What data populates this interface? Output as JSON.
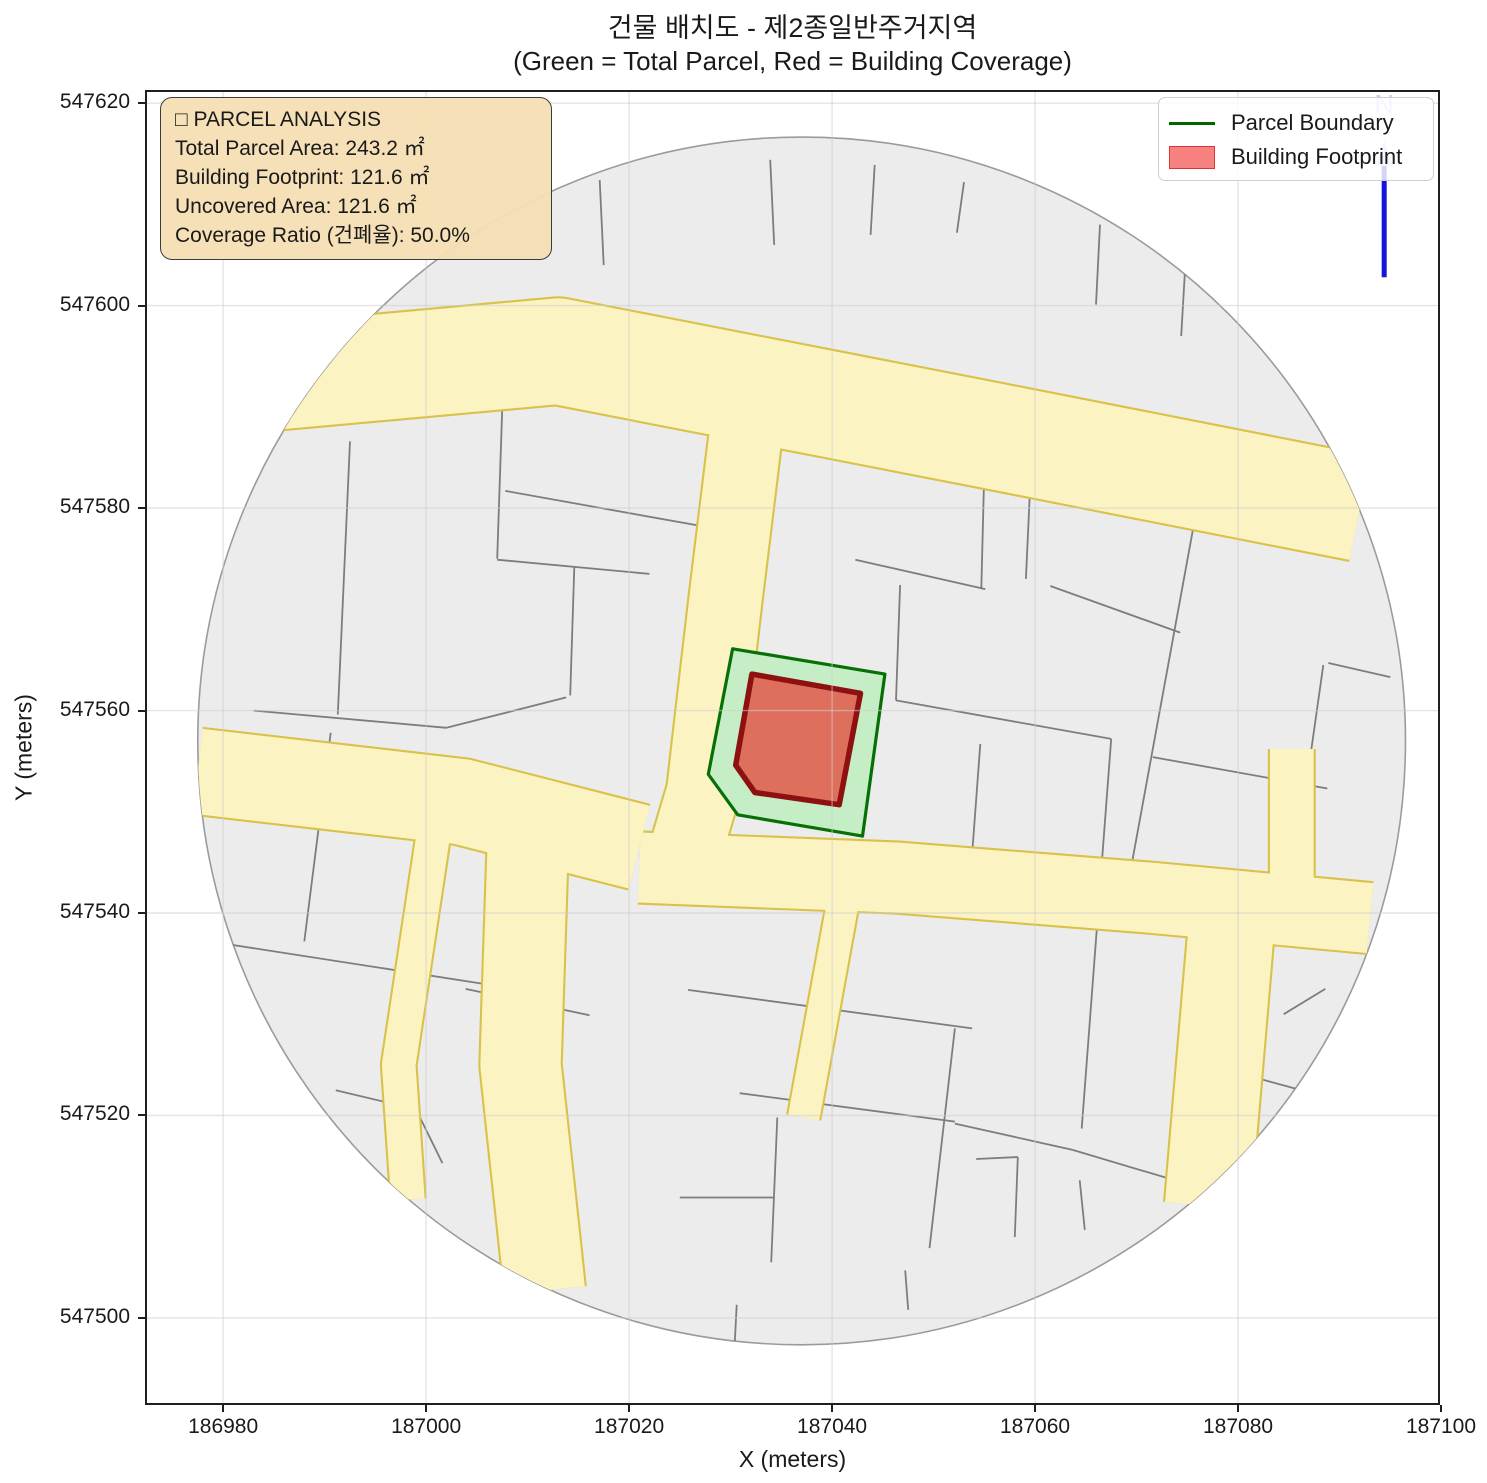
{
  "title": {
    "line1": "건물 배치도 - 제2종일반주거지역",
    "line2": "(Green = Total Parcel, Red = Building Coverage)"
  },
  "info_box": {
    "title": "□ PARCEL ANALYSIS",
    "lines": [
      "Total Parcel Area: 243.2 ㎡",
      "Building Footprint: 121.6 ㎡",
      "Uncovered Area: 121.6 ㎡",
      "Coverage Ratio (건폐율): 50.0%"
    ]
  },
  "legend": {
    "items": [
      {
        "label": "Parcel Boundary",
        "type": "line",
        "color": "#006400"
      },
      {
        "label": "Building Footprint",
        "type": "patch",
        "fill": "#f78080",
        "edge": "#dd3333"
      }
    ]
  },
  "colors": {
    "background": "#ffffff",
    "parcel_fill": "#ececec",
    "parcel_edge": "#7d7d7d",
    "road_fill": "#fcf3c3",
    "road_edge": "#d9c24a",
    "region_edge": "#9b9b9b",
    "grid": "rgba(205,205,205,0.55)",
    "target_parcel_fill": "#c6eec6",
    "target_parcel_edge": "#067006",
    "building_fill": "#df6f5d",
    "building_edge": "#8e1111",
    "north_arrow": "#1414dd",
    "north_faint": "rgba(125,135,235,0.45)",
    "infobox_bg": "rgba(245,222,179,0.95)",
    "infobox_border": "#3b3b3b",
    "spine": "#1f1f1f"
  },
  "chart_data": {
    "type": "map",
    "title": "건물 배치도 - 제2종일반주거지역",
    "subtitle": "(Green = Total Parcel, Red = Building Coverage)",
    "xlabel": "X (meters)",
    "ylabel": "Y (meters)",
    "xlim": [
      186972.3,
      187099.9
    ],
    "ylim": [
      547491.4,
      547621.3
    ],
    "x_ticks": [
      186980,
      187000,
      187020,
      187040,
      187060,
      187080,
      187100
    ],
    "y_ticks": [
      547500,
      547520,
      547540,
      547560,
      547580,
      547600,
      547620
    ],
    "grid": true,
    "legend_position": "upper right",
    "analysis": {
      "zoning": "제2종일반주거지역",
      "total_parcel_area_m2": 243.2,
      "building_footprint_m2": 121.6,
      "uncovered_area_m2": 121.6,
      "coverage_ratio_pct": 50.0
    },
    "region_circle": {
      "cx": 187037.0,
      "cy": 547557.0,
      "r": 59.5
    },
    "parcel_boundary": [
      [
        187030.2,
        547566.1
      ],
      [
        187045.2,
        547563.6
      ],
      [
        187043.0,
        547547.6
      ],
      [
        187030.7,
        547549.7
      ],
      [
        187027.8,
        547553.7
      ]
    ],
    "building_footprint": [
      [
        187032.1,
        547563.6
      ],
      [
        187042.8,
        547561.7
      ],
      [
        187040.7,
        547550.7
      ],
      [
        187032.4,
        547551.9
      ],
      [
        187030.5,
        547554.6
      ]
    ],
    "roads": [
      {
        "pts": [
          [
            186980.0,
            547592.5
          ],
          [
            187013.0,
            547595.5
          ],
          [
            187056.5,
            547587.0
          ],
          [
            187092.0,
            547580.0
          ]
        ],
        "w": 10.5
      },
      {
        "pts": [
          [
            187032.0,
            547591.5
          ],
          [
            187029.5,
            547571.0
          ],
          [
            187027.3,
            547552.0
          ],
          [
            187024.8,
            547543.5
          ]
        ],
        "w": 7.2
      },
      {
        "pts": [
          [
            186977.5,
            547554.0
          ],
          [
            187003.5,
            547551.0
          ],
          [
            187021.0,
            547546.5
          ]
        ],
        "w": 8.5
      },
      {
        "pts": [
          [
            187021.0,
            547544.5
          ],
          [
            187046.5,
            547543.5
          ],
          [
            187071.5,
            547541.5
          ],
          [
            187093.0,
            547539.5
          ]
        ],
        "w": 7.0
      },
      {
        "pts": [
          [
            187010.0,
            547546.5
          ],
          [
            187009.3,
            547525.0
          ],
          [
            187011.7,
            547502.7
          ]
        ],
        "w": 8.0
      },
      {
        "pts": [
          [
            187000.9,
            547549.0
          ],
          [
            186997.3,
            547525.0
          ],
          [
            186998.2,
            547511.7
          ]
        ],
        "w": 3.4
      },
      {
        "pts": [
          [
            187041.2,
            547541.8
          ],
          [
            187037.2,
            547519.8
          ]
        ],
        "w": 3.2
      },
      {
        "pts": [
          [
            187085.3,
            547556.2
          ],
          [
            187085.3,
            547540.5
          ]
        ],
        "w": 4.4
      },
      {
        "pts": [
          [
            187079.5,
            547540.5
          ],
          [
            187077.0,
            547511.1
          ]
        ],
        "w": 8.5
      }
    ],
    "parcel_lines": [
      [
        186992.5,
        547586.6,
        186991.3,
        547559.6
      ],
      [
        187007.6,
        547593.0,
        187007.0,
        547575.0
      ],
      [
        187007.0,
        547574.9,
        187022.0,
        547573.5
      ],
      [
        187014.6,
        547574.2,
        187014.2,
        547561.5
      ],
      [
        186983.0,
        547560.0,
        187002.0,
        547558.3
      ],
      [
        187002.0,
        547558.3,
        187013.8,
        547561.3
      ],
      [
        187007.8,
        547581.7,
        187026.7,
        547578.3
      ],
      [
        187017.1,
        547612.4,
        187017.5,
        547604.0
      ],
      [
        187033.9,
        547614.4,
        187034.3,
        547606.0
      ],
      [
        187044.2,
        547613.9,
        187043.8,
        547607.0
      ],
      [
        187053.0,
        547612.2,
        187052.3,
        547607.2
      ],
      [
        187066.4,
        547608.0,
        187066.0,
        547600.1
      ],
      [
        187074.8,
        547604.0,
        187074.4,
        547597.0
      ],
      [
        187046.7,
        547572.4,
        187046.3,
        547561.0
      ],
      [
        187042.3,
        547574.9,
        187055.1,
        547572.0
      ],
      [
        187055.1,
        547587.7,
        187054.7,
        547572.0
      ],
      [
        187059.5,
        547581.8,
        187059.1,
        547573.0
      ],
      [
        187046.3,
        547561.0,
        187067.5,
        547557.2
      ],
      [
        187067.5,
        547557.2,
        187064.6,
        547518.7
      ],
      [
        187054.6,
        547556.7,
        187053.8,
        547545.8
      ],
      [
        187076.4,
        547582.5,
        187069.1,
        547542.5
      ],
      [
        187061.5,
        547572.3,
        187074.3,
        547567.7
      ],
      [
        187071.6,
        547555.4,
        187088.8,
        547552.3
      ],
      [
        187088.4,
        547564.5,
        187087.1,
        547555.3
      ],
      [
        187088.9,
        547564.7,
        187095.0,
        547563.3
      ],
      [
        186978.0,
        547537.3,
        187006.3,
        547532.9
      ],
      [
        186990.6,
        547557.8,
        186988.0,
        547537.2
      ],
      [
        186991.1,
        547522.5,
        186999.0,
        547520.6
      ],
      [
        186999.0,
        547520.6,
        187001.6,
        547515.3
      ],
      [
        187003.9,
        547532.5,
        187016.1,
        547529.9
      ],
      [
        187025.8,
        547532.4,
        187053.8,
        547528.6
      ],
      [
        187030.9,
        547522.2,
        187052.1,
        547519.4
      ],
      [
        187052.1,
        547528.6,
        187049.6,
        547506.9
      ],
      [
        187034.6,
        547519.8,
        187034.0,
        547505.5
      ],
      [
        187025.0,
        547511.9,
        187034.2,
        547511.9
      ],
      [
        187054.2,
        547515.7,
        187058.3,
        547515.9
      ],
      [
        187058.3,
        547515.9,
        187058.0,
        547508.0
      ],
      [
        187030.6,
        547501.3,
        187030.4,
        547497.4
      ],
      [
        187047.2,
        547504.7,
        187047.5,
        547500.8
      ],
      [
        187052.1,
        547519.2,
        187063.7,
        547516.6
      ],
      [
        187063.7,
        547516.6,
        187075.1,
        547513.2
      ],
      [
        187079.6,
        547524.3,
        187088.8,
        547521.8
      ],
      [
        187084.5,
        547530.0,
        187088.6,
        547532.5
      ],
      [
        187064.4,
        547513.6,
        187064.9,
        547508.7
      ]
    ],
    "north_arrow": {
      "x": 187094.4,
      "tip_y": 547616.3,
      "line_top_y": 547613.8,
      "line_bottom_y": 547602.8,
      "label": "N",
      "label_y": 547619.0
    }
  }
}
